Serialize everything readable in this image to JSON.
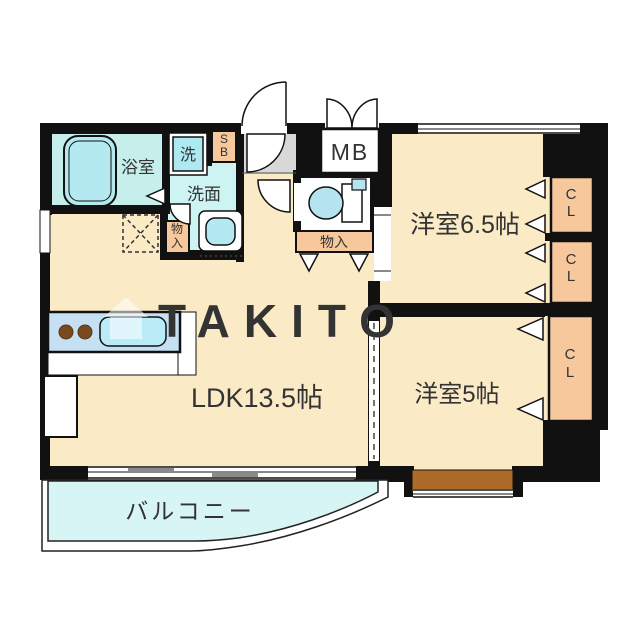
{
  "watermark": {
    "text": "TAKITO"
  },
  "rooms": {
    "bath": {
      "label": "浴室"
    },
    "washer": {
      "label": "洗"
    },
    "washroom": {
      "label": "洗面"
    },
    "shoe_box": {
      "label": "SB"
    },
    "meter_box": {
      "label": "MB"
    },
    "storage_hall": {
      "label": "物入"
    },
    "storage_toilet": {
      "label": "物入"
    },
    "western_room_1": {
      "label": "洋室6.5帖"
    },
    "western_room_2": {
      "label": "洋室5帖"
    },
    "ldk": {
      "label": "LDK13.5帖"
    },
    "balcony": {
      "label": "バルコニー"
    },
    "closet_1": {
      "label": "CL"
    },
    "closet_2": {
      "label": "CL"
    },
    "closet_3": {
      "label": "CL"
    }
  },
  "colors": {
    "wall": "#111111",
    "floor": "#faeac6",
    "water_rooms": "#cdf3f3",
    "balcony": "#d7f5f4",
    "closet": "#f6c89c",
    "window_sill": "#ad6b2a",
    "kitchen_counter": "#c5e0f2",
    "entrance_floor": "#d8d8d8"
  }
}
